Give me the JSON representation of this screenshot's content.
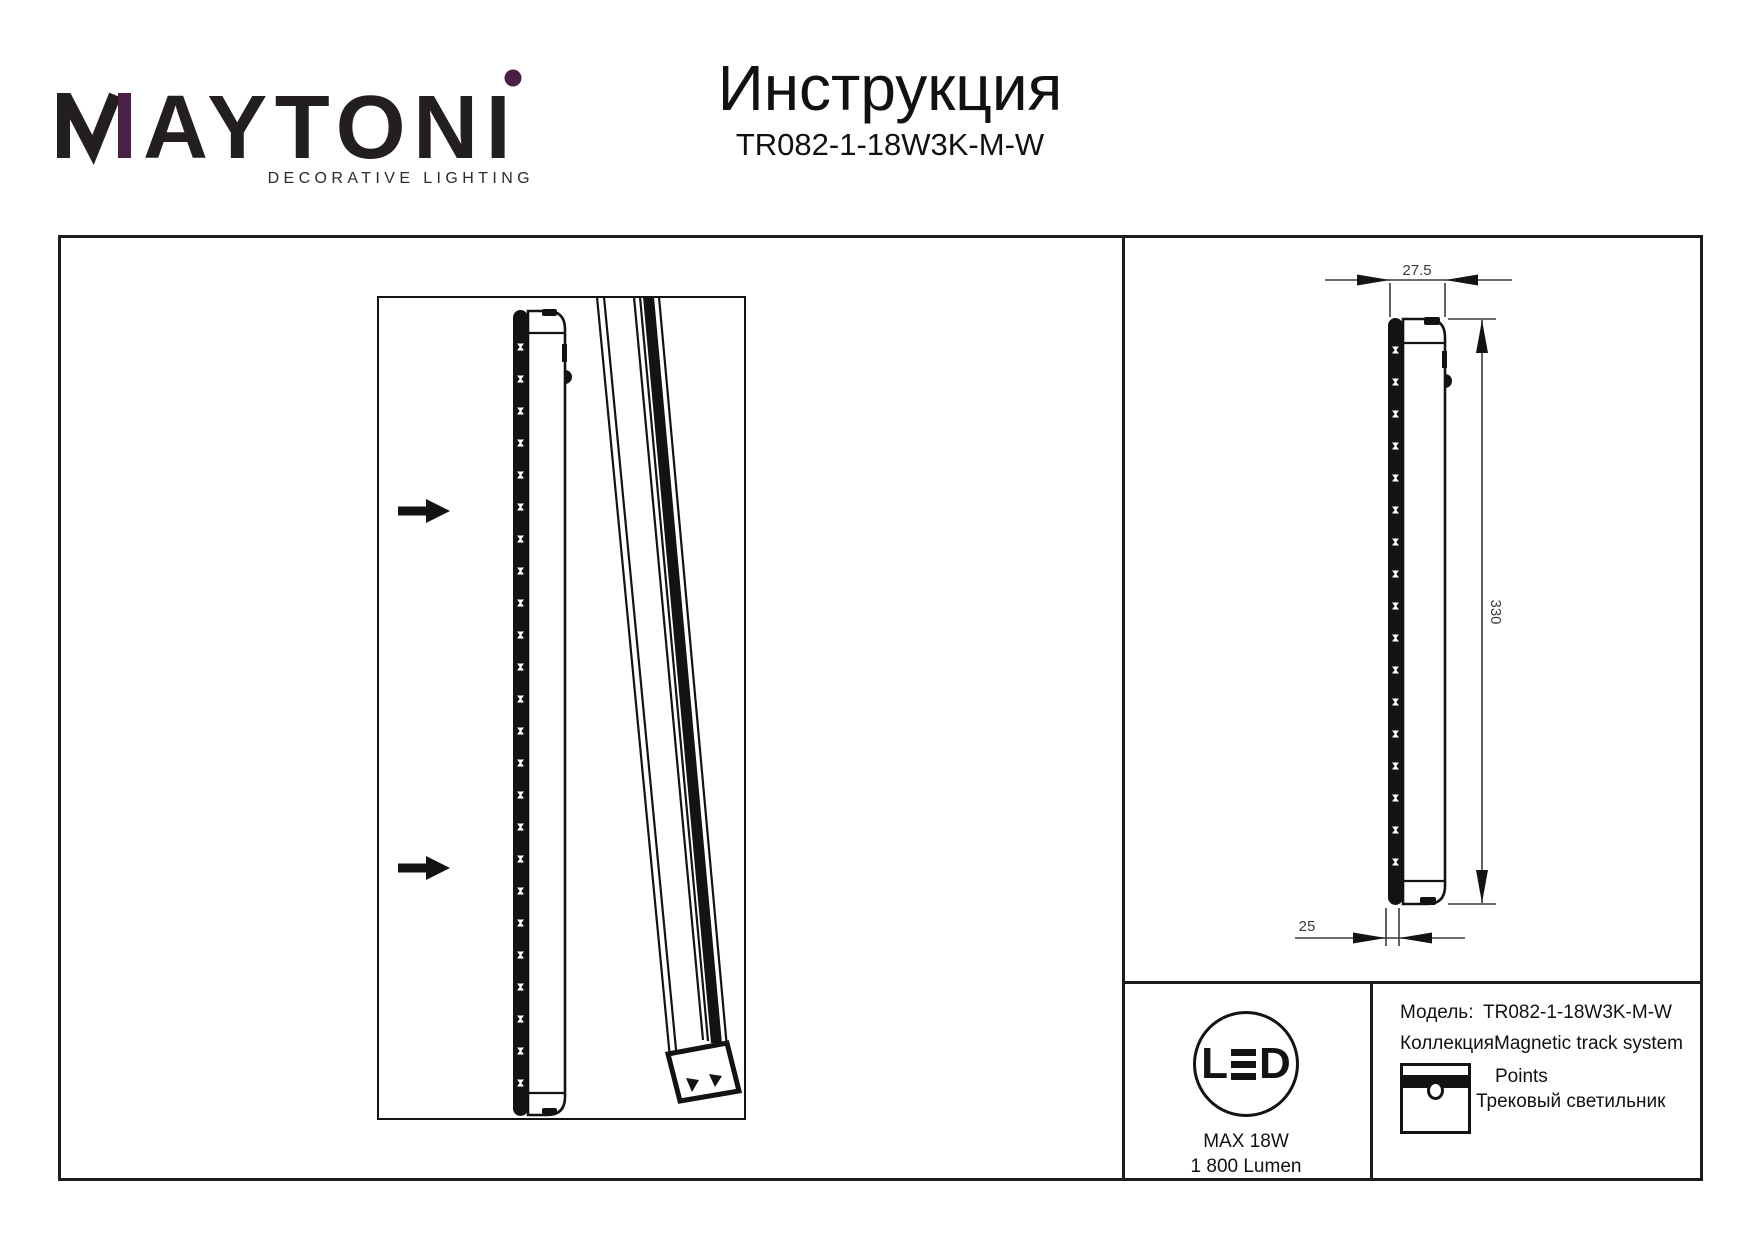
{
  "header": {
    "brand": {
      "name": "MAYTONI",
      "name_after_m": "AYTONI",
      "tagline": "DECORATIVE LIGHTING",
      "accent_color": "#4A2145",
      "ink_color": "#231f20"
    },
    "title": "Инструкция",
    "model_code": "TR082-1-18W3K-M-W"
  },
  "drawing": {
    "dimensions": {
      "width_mm": "27.5",
      "length_mm": "330",
      "base_mm": "25"
    }
  },
  "info": {
    "led_badge": {
      "l": "L",
      "d": "D",
      "max_power": "MAX 18W",
      "luminous_flux": "1 800 Lumen"
    },
    "table": {
      "model_label": "Модель:",
      "model_value": "TR082-1-18W3K-M-W",
      "collection_label": "Коллекция:",
      "collection_value": "Magnetic track system",
      "series_name": "Points",
      "product_type": "Трековый светильник"
    }
  }
}
